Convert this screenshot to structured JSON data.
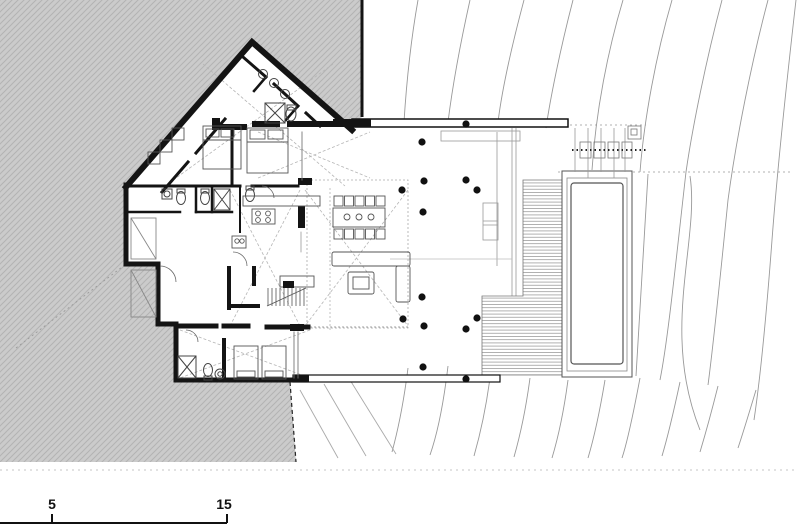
{
  "drawing": {
    "kind": "architectural site floor plan",
    "description": "Single-storey house cut into a hatched hillside, with terrace, wood deck and lap pool over contoured terrain"
  },
  "scale_bar": {
    "tick_labels": [
      "5",
      "15"
    ]
  },
  "colors": {
    "paper": "#ffffff",
    "terrain_fill": "#cbcbcb",
    "terrain_hatch": "#b3b3b3",
    "wall_black": "#141414",
    "thin_line": "#666666",
    "contour_gray": "#999999"
  }
}
